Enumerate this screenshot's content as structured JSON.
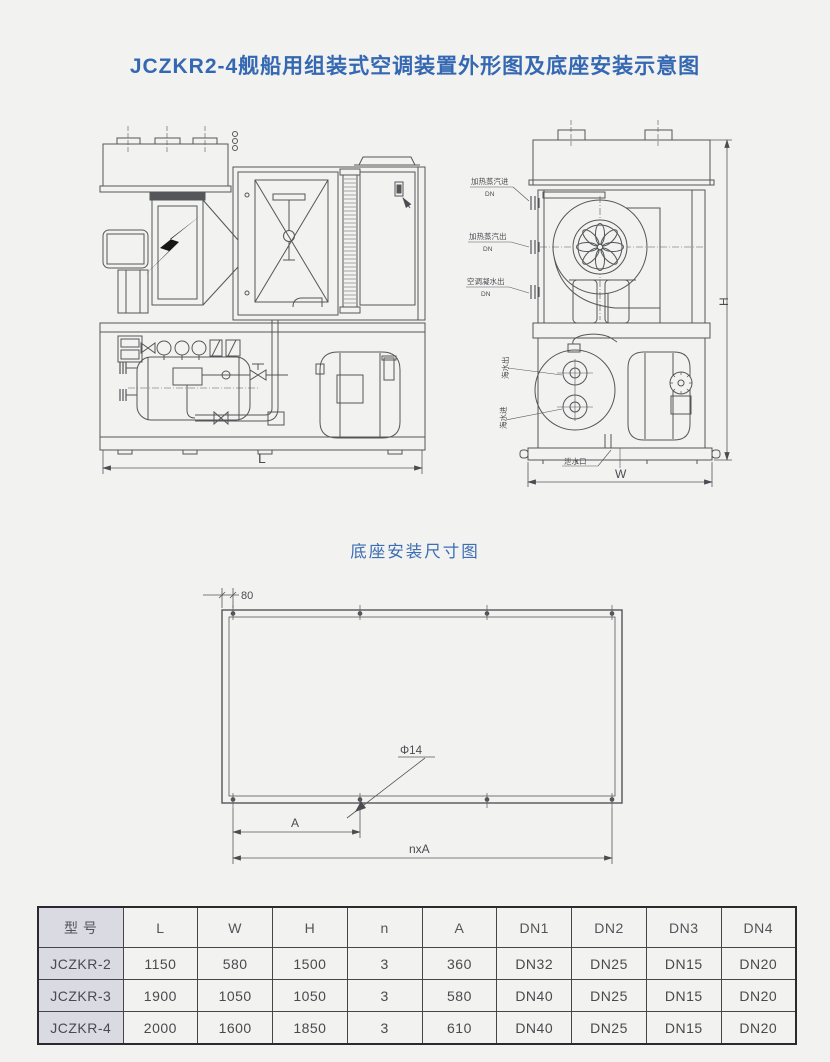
{
  "page": {
    "title": "JCZKR2-4舰船用组装式空调装置外形图及底座安装示意图"
  },
  "front_view": {
    "dim_l": "L"
  },
  "side_view": {
    "dim_h": "H",
    "dim_w": "W",
    "labels": {
      "steam_in": "加热蒸汽进",
      "steam_out": "加热蒸汽出",
      "condensate": "空调凝水出",
      "dn": "DN",
      "sea_out": "海水出",
      "sea_in": "海水进",
      "drain": "泄水口"
    }
  },
  "base_plan": {
    "title": "底座安装尺寸图",
    "dim_edge": "80",
    "dim_hole": "Φ14",
    "dim_pitch": "A",
    "dim_total": "nxA"
  },
  "table": {
    "headers": [
      "型 号",
      "L",
      "W",
      "H",
      "n",
      "A",
      "DN1",
      "DN2",
      "DN3",
      "DN4"
    ],
    "rows": [
      {
        "cells": [
          "JCZKR-2",
          "1150",
          "580",
          "1500",
          "3",
          "360",
          "DN32",
          "DN25",
          "DN15",
          "DN20"
        ]
      },
      {
        "cells": [
          "JCZKR-3",
          "1900",
          "1050",
          "1050",
          "3",
          "580",
          "DN40",
          "DN25",
          "DN15",
          "DN20"
        ]
      },
      {
        "cells": [
          "JCZKR-4",
          "2000",
          "1600",
          "1850",
          "3",
          "610",
          "DN40",
          "DN25",
          "DN15",
          "DN20"
        ]
      }
    ]
  }
}
